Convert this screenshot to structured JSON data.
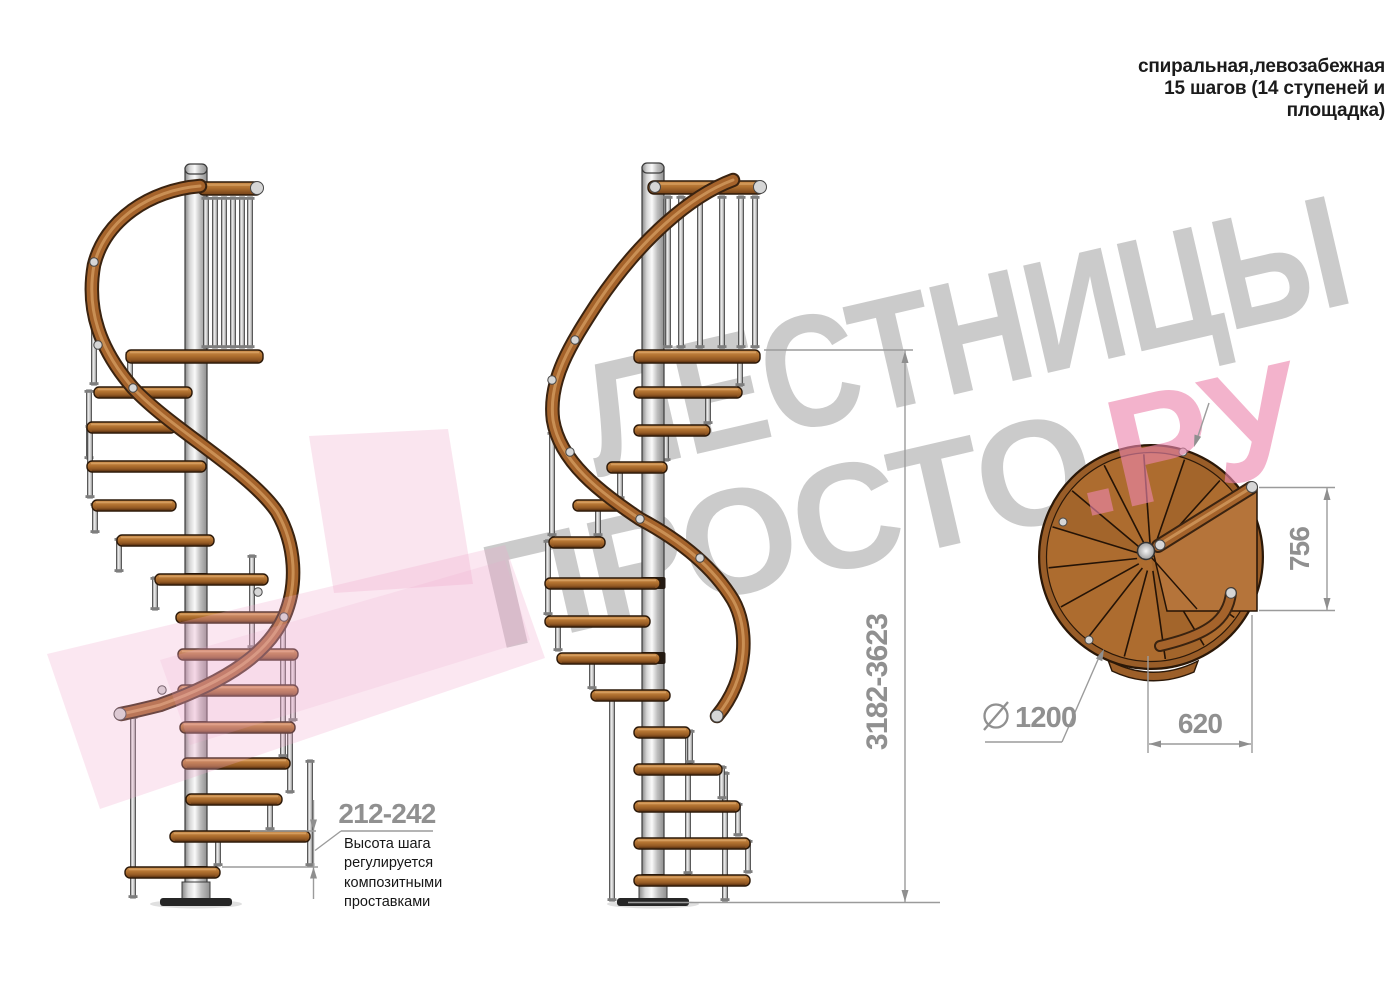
{
  "title": {
    "text": "спиральная,левозабежная\n15 шагов (14 ступеней и\nплощадка)"
  },
  "watermark": {
    "word1": "ЛЕСТНИЦЫ",
    "word2": "ПРОСТО",
    "suffix": ".РУ",
    "gray": "#9c9c9c",
    "pink": "#ec86ad",
    "arrow_pink": "#f0a8cb"
  },
  "annotations": {
    "step_height": {
      "value": "212-242",
      "note": "Высота шага\nрегулируется\nкомпозитными\nпроставками"
    },
    "total_height": {
      "value": "3182-3623"
    },
    "plan": {
      "depth": "756",
      "landing_width": "620",
      "diameter": "1200",
      "diameter_symbol": "⌀"
    }
  },
  "colors": {
    "wood": "#b0702f",
    "wood_light": "#cf9250",
    "wood_dark": "#8a5220",
    "rim": "#995d28",
    "rail": "#a5632b",
    "rail_shadow": "#3a2310",
    "metal_light": "#f2f2f2",
    "metal_mid": "#bdbdbd",
    "outline": "#2b1808",
    "dim_line": "#9b9b9b",
    "dim_text": "#909090",
    "note_text": "#161616",
    "title_text": "#1b1b1b"
  }
}
